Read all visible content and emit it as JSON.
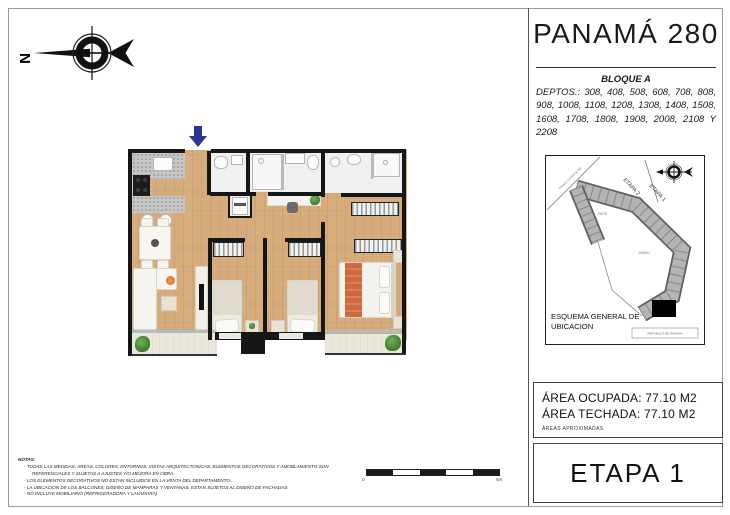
{
  "title_block": {
    "title": "PANAMÁ 280",
    "block_label": "BLOQUE A",
    "depts_line": "DEPTOS.: 308, 408, 508, 608, 708, 808, 908, 1008, 1108, 1208, 1308, 1408, 1508, 1608, 1708, 1808, 1908, 2008, 2108 Y 2208"
  },
  "site_map": {
    "caption_line1": "ESQUEMA GENERAL DE",
    "caption_line2": "UBICACION",
    "etapa2_label": "ETAPA 2",
    "etapa1_label": "ETAPA 1",
    "patio_label": "PATIO",
    "jardin_label": "JARDIN",
    "street_label": "PRIMO GERBOLINI",
    "avenue_label": "REPUBLICA DE PANAMA"
  },
  "areas": {
    "occupied": "ÁREA OCUPADA: 77.10 M2",
    "roofed": "ÁREA TECHADA: 77.10 M2",
    "note": "ÁREAS APROXIMADAS"
  },
  "etapa_box": {
    "label": "ETAPA 1"
  },
  "compass": {
    "letter": "N"
  },
  "scale_bar": {
    "start_label": "0",
    "end_label": "5m"
  },
  "notes": {
    "heading": "NOTAS:",
    "items": [
      "TODAS LAS MEDIDAS, AREAS, COLORES, ENTORNOS, VISTAS ARQUITECTONICAS, ELEMENTOS DECORATIVOS Y AMOBLAMIENTO SON REFERENCIALES Y SUJETAS A AJUSTES Y/O MEJORA EN OBRA.",
      "LOS ELEMENTOS DECORATIVOS NO ESTAN INCLUIDOS EN LA VENTA DEL DEPARTAMENTO.",
      "LA UBICACION DE LOS BALCONES, DISEÑO DE MAMPARAS Y VENTANAS, ESTAN SUJETOS AL DISEÑO DE FACHADAS",
      "NO INCLUYE MOBILIARIO (REFRIGERADORA Y LAVADORA)"
    ]
  },
  "colors": {
    "entry_arrow": "#2b3596",
    "wood_floor": "#d7ac7c",
    "wall": "#161616",
    "bed_runner": "#cd6a41",
    "plant_green": "#3c7a2e",
    "highlight_unit": "#000000"
  }
}
